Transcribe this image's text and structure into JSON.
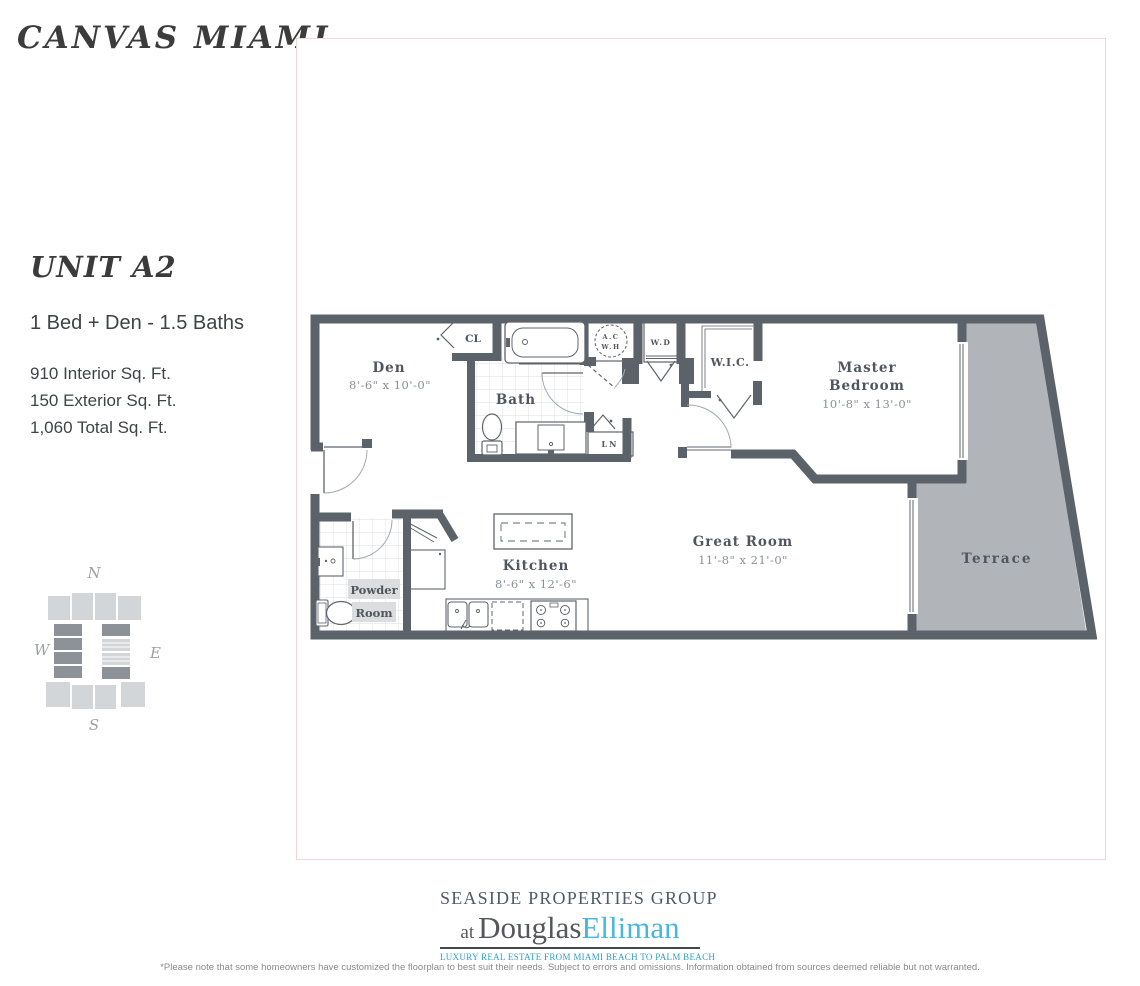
{
  "page": {
    "title": "CANVAS MIAMI"
  },
  "unit": {
    "name": "UNIT A2",
    "layout": "1 Bed + Den - 1.5 Baths",
    "area_lines": [
      "910 Interior Sq. Ft.",
      "150 Exterior Sq. Ft.",
      "1,060 Total Sq. Ft."
    ]
  },
  "compass": {
    "n": "N",
    "s": "S",
    "e": "E",
    "w": "W"
  },
  "plan": {
    "den": {
      "name": "Den",
      "dims": "8'-6\" x 10'-0\""
    },
    "cl": {
      "name": "CL"
    },
    "bath": {
      "name": "Bath"
    },
    "acwh": {
      "line1": "A.C",
      "line2": "W.H"
    },
    "wd": {
      "name": "W.D"
    },
    "wic": {
      "name": "W.I.C."
    },
    "ln": {
      "name": "LN"
    },
    "master": {
      "line1": "Master",
      "line2": "Bedroom",
      "dims": "10'-8\" x 13'-0\""
    },
    "great": {
      "name": "Great Room",
      "dims": "11'-8\" x 21'-0\""
    },
    "kitchen": {
      "name": "Kitchen",
      "dims": "8'-6\" x 12'-6\""
    },
    "powder": {
      "line1": "Powder",
      "line2": "Room"
    },
    "terrace": {
      "name": "Terrace"
    },
    "colors": {
      "wall": "#5c6269",
      "terrace_fill": "#b1b5ba",
      "label": "#4f565e",
      "dim": "#8b9198"
    }
  },
  "footer": {
    "brand_top": "SEASIDE PROPERTIES GROUP",
    "brand_at": "at",
    "brand_douglas": "Douglas",
    "brand_elliman": "Elliman",
    "tagline": "LUXURY REAL ESTATE FROM MIAMI BEACH TO PALM BEACH",
    "disclaimer": "*Please note that some homeowners have customized the floorplan to best suit their needs. Subject to errors and omissions. Information obtained from sources deemed reliable but not warranted."
  }
}
